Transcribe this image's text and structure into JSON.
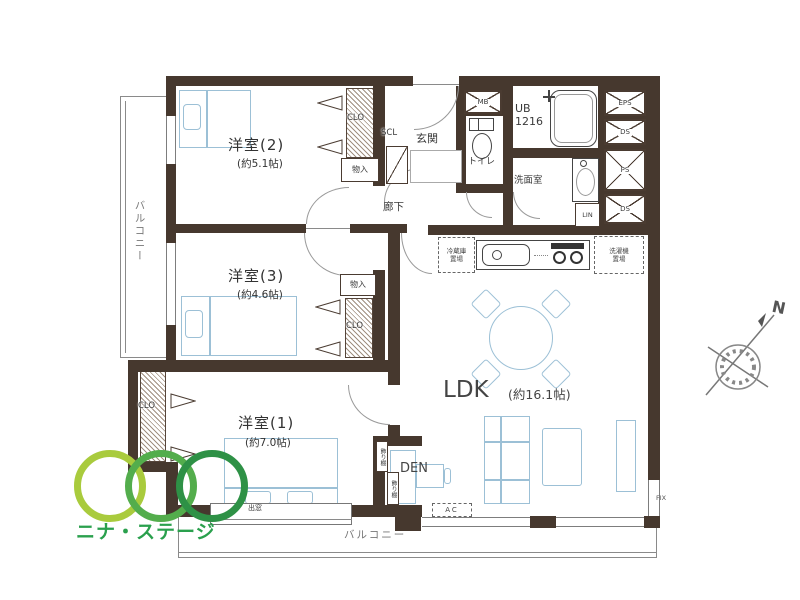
{
  "rooms": {
    "western2": {
      "name": "洋室(2)",
      "size": "(約5.1帖)"
    },
    "western3": {
      "name": "洋室(3)",
      "size": "(約4.6帖)"
    },
    "western1": {
      "name": "洋室(1)",
      "size": "(約7.0帖)"
    },
    "ldk": {
      "name": "LDK",
      "size": "(約16.1帖)"
    },
    "entrance": "玄関",
    "hallway": "廊下",
    "toilet": "トイレ",
    "washroom": "洗面室",
    "unit_bath": "UB\n1216",
    "den": "DEN"
  },
  "storage": {
    "closet_w2": "CLO",
    "closet_w3": "CLO",
    "closet_w1": "CLO",
    "storage_w2": "物入",
    "storage_w3": "物入",
    "shoe_closet": "SCL",
    "linen": "LIN",
    "display_shelf_1": "飾り棚",
    "display_shelf_2": "飾り棚"
  },
  "service": {
    "meter_box": "MB",
    "eps": "EPS",
    "ds_upper": "DS",
    "ps": "PS",
    "ds_lower": "DS",
    "fridge_space": "冷蔵庫\n置場",
    "washer_space": "洗濯機\n置場",
    "ac_unit": "AC",
    "fix_window": "FIX"
  },
  "outdoor": {
    "balcony_left": "バルコニー",
    "balcony_bottom": "バルコニー",
    "bay_window": "出窓"
  },
  "compass": {
    "north": "N"
  },
  "logo": {
    "text": "ニナ・ステージ",
    "ring_color_1": "#a9cb3d",
    "ring_color_2": "#53ad4c",
    "ring_color_3": "#2e9146",
    "text_color": "#2aa04d"
  },
  "colors": {
    "wall": "#46382e",
    "furniture_line": "#9cc0d6",
    "thin_line": "#8a8a8a"
  }
}
